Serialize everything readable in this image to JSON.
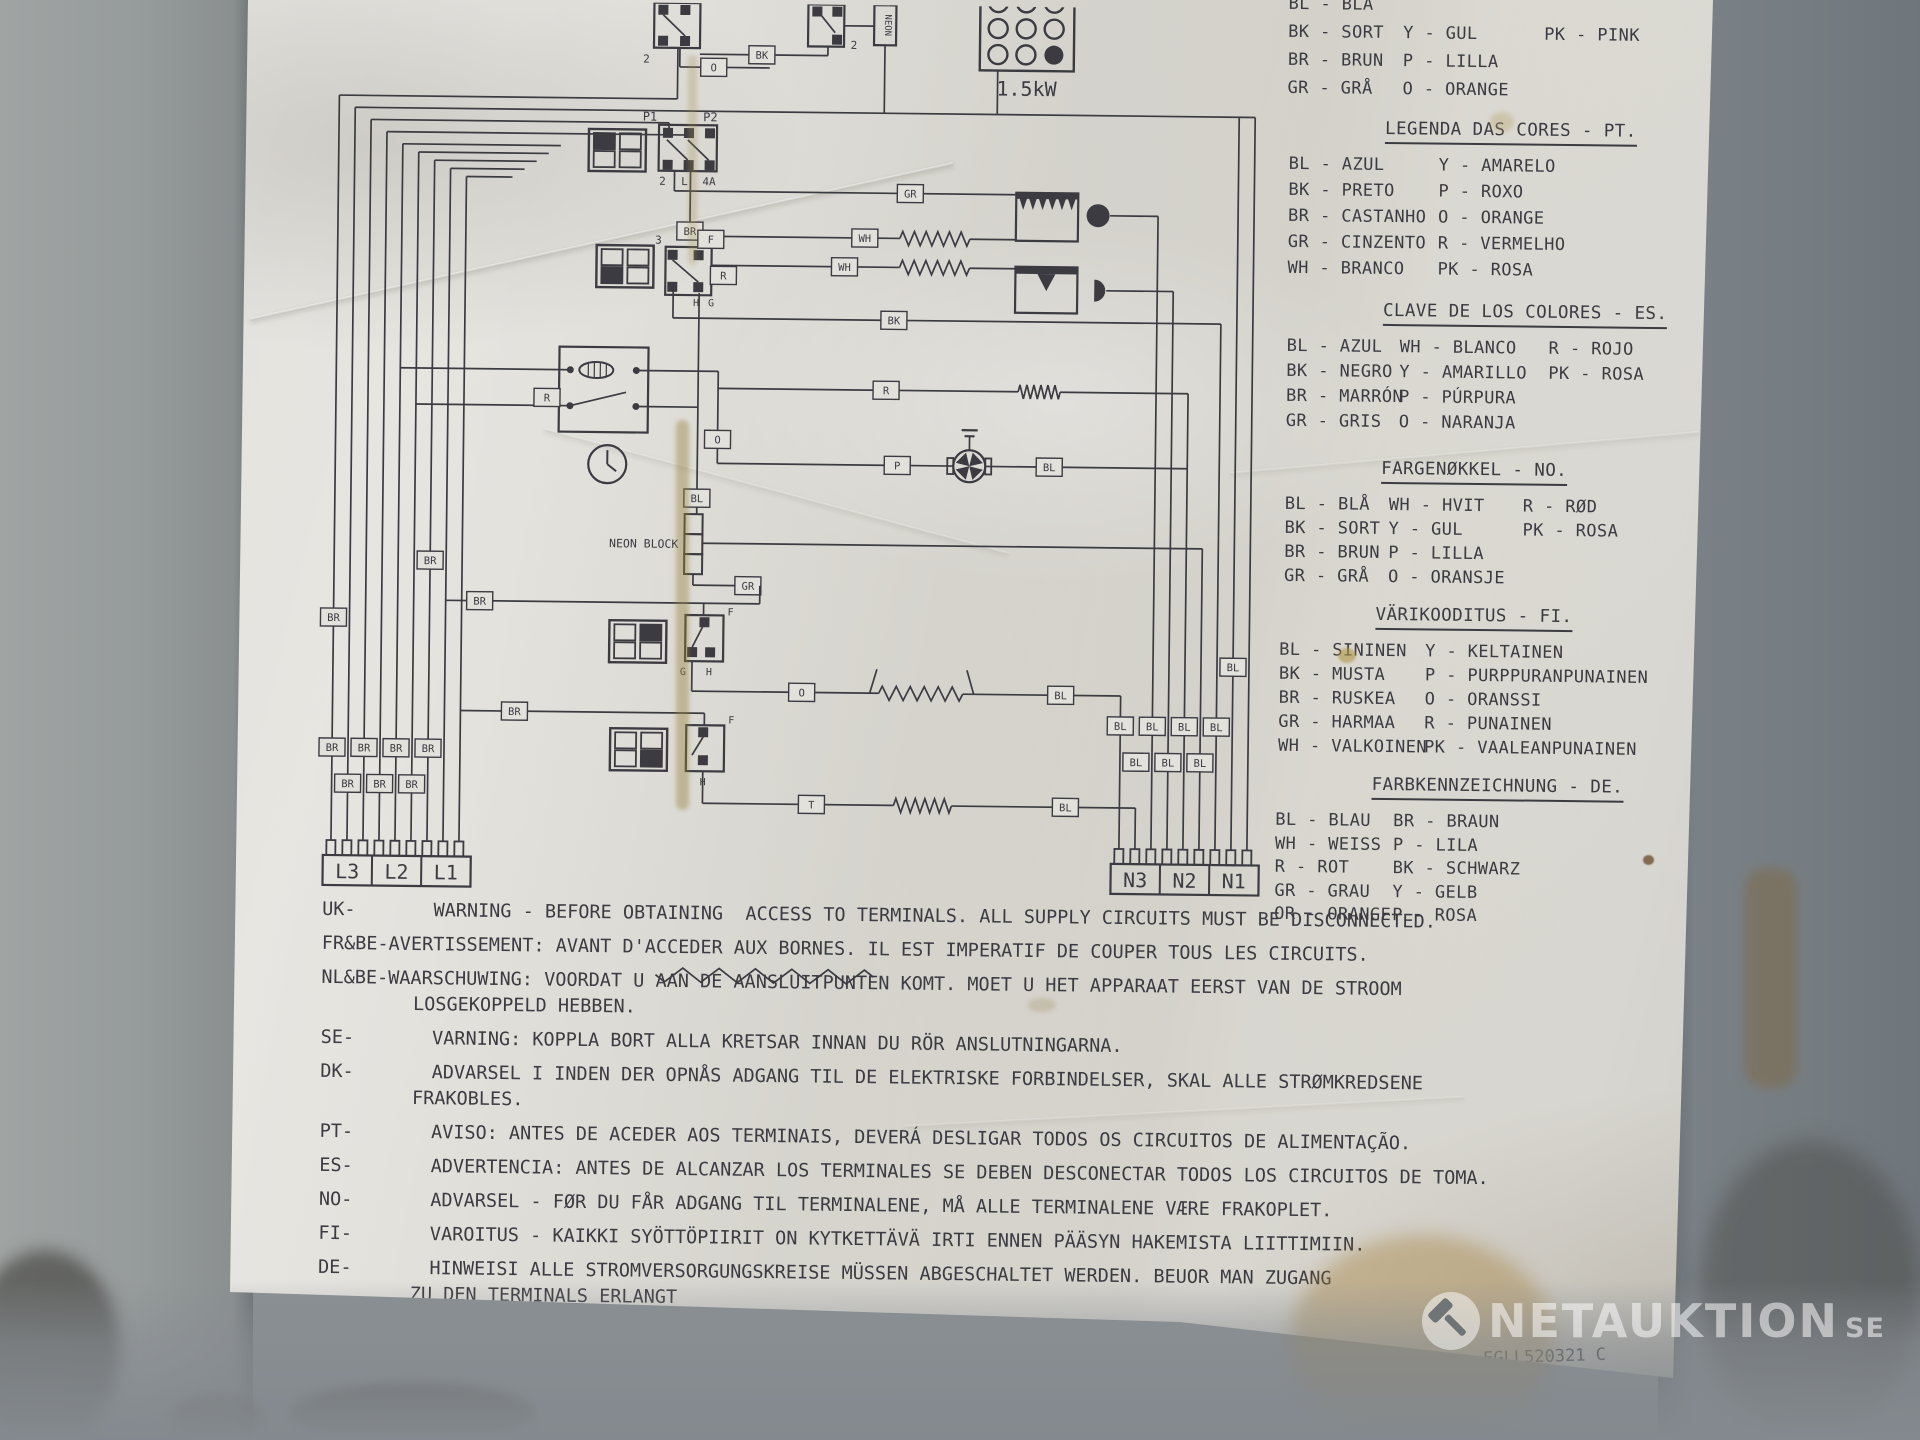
{
  "paper": {
    "legends": [
      {
        "id": "dk-partial",
        "title": "",
        "rows": [
          [
            "BL - BLÅ",
            "",
            ""
          ],
          [
            "BK - SORT",
            "Y - GUL",
            "PK - PINK"
          ],
          [
            "BR - BRUN",
            "P - LILLA",
            ""
          ],
          [
            "GR - GRÅ",
            "O - ORANGE",
            ""
          ]
        ]
      },
      {
        "id": "pt",
        "title": "LEGENDA DAS CORES - PT.",
        "rows": [
          [
            "BL - AZUL",
            "Y - AMARELO"
          ],
          [
            "BK - PRETO",
            "P - ROXO"
          ],
          [
            "BR - CASTANHO",
            "O - ORANGE"
          ],
          [
            "GR - CINZENTO",
            "R - VERMELHO"
          ],
          [
            "WH - BRANCO",
            "PK - ROSA"
          ]
        ]
      },
      {
        "id": "es",
        "title": "CLAVE DE LOS COLORES - ES.",
        "rows": [
          [
            "BL - AZUL",
            "WH - BLANCO",
            "R - ROJO"
          ],
          [
            "BK - NEGRO",
            "Y - AMARILLO",
            "PK - ROSA"
          ],
          [
            "BR - MARRÓN",
            "P - PÚRPURA",
            ""
          ],
          [
            "GR - GRIS",
            "O - NARANJA",
            ""
          ]
        ]
      },
      {
        "id": "no",
        "title": "FARGENØKKEL - NO.",
        "rows": [
          [
            "BL - BLÅ",
            "WH - HVIT",
            "R - RØD"
          ],
          [
            "BK - SORT",
            "Y - GUL",
            "PK - ROSA"
          ],
          [
            "BR - BRUN",
            "P - LILLA",
            ""
          ],
          [
            "GR - GRÅ",
            "O - ORANSJE",
            ""
          ]
        ]
      },
      {
        "id": "fi",
        "title": "VÄRIKOODITUS - FI.",
        "rows": [
          [
            "BL - SININEN",
            "Y - KELTAINEN"
          ],
          [
            "BK - MUSTA",
            "P - PURPPURANPUNAINEN"
          ],
          [
            "BR - RUSKEA",
            "O - ORANSSI"
          ],
          [
            "GR - HARMAA",
            "R - PUNAINEN"
          ],
          [
            "WH - VALKOINEN",
            "PK - VAALEANPUNAINEN"
          ]
        ]
      },
      {
        "id": "de",
        "title": "FARBKENNZEICHNUNG - DE.",
        "rows": [
          [
            "BL - BLAU",
            "BR - BRAUN"
          ],
          [
            "WH - WEISS",
            "P - LILA"
          ],
          [
            "R - ROT",
            "BK - SCHWARZ"
          ],
          [
            "GR - GRAU",
            "Y - GELB"
          ],
          [
            "OR - ORANGE",
            "P - ROSA"
          ]
        ]
      }
    ],
    "warnings": [
      {
        "code": "UK-",
        "text": "WARNING - BEFORE OBTAINING  ACCESS TO TERMINALS. ALL SUPPLY CIRCUITS MUST BE DISCONNECTED."
      },
      {
        "code": "FR&BE-",
        "text": "AVERTISSEMENT: AVANT D'ACCEDER AUX BORNES. IL EST IMPERATIF DE COUPER TOUS LES CIRCUITS."
      },
      {
        "code": "NL&BE-",
        "text": "WAARSCHUWING: VOORDAT U AAN DE AANSLUITPUNTEN KOMT. MOET U HET APPARAAT EERST VAN DE STROOM\nLOSGEKOPPELD HEBBEN."
      },
      {
        "code": "SE-",
        "text": "VARNING: KOPPLA BORT ALLA KRETSAR INNAN DU RÖR ANSLUTNINGARNA."
      },
      {
        "code": "DK-",
        "text": "ADVARSEL I INDEN DER OPNÅS ADGANG TIL DE ELEKTRISKE FORBINDELSER, SKAL ALLE STRØMKREDSENE\nFRAKOBLES."
      },
      {
        "code": "PT-",
        "text": "AVISO: ANTES DE ACEDER AOS TERMINAIS, DEVERÁ DESLIGAR TODOS OS CIRCUITOS DE ALIMENTAÇÃO."
      },
      {
        "code": "ES-",
        "text": "ADVERTENCIA: ANTES DE ALCANZAR LOS TERMINALES SE DEBEN DESCONECTAR TODOS LOS CIRCUITOS DE TOMA."
      },
      {
        "code": "NO-",
        "text": "ADVARSEL - FØR DU FÅR ADGANG TIL TERMINALENE, MÅ ALLE TERMINALENE VÆRE FRAKOPLET."
      },
      {
        "code": "FI-",
        "text": "VAROITUS - KAIKKI SYÖTTÖPIIRIT ON KYTKETTÄVÄ IRTI ENNEN PÄÄSYN HAKEMISTA LIITTIMIIN."
      },
      {
        "code": "DE-",
        "text": "HINWEISI ALLE STROMVERSORGUNGSKREISE MÜSSEN ABGESCHALTET WERDEN. BEUOR MAN ZUGANG\nZU DEN TERMINALS ERLANGT"
      }
    ],
    "doc_number": "EGLL520321 C"
  },
  "schematic": {
    "wire_colors": {
      "BK": "BK",
      "BL": "BL",
      "BR": "BR",
      "GR": "GR",
      "WH": "WH",
      "O": "O",
      "R": "R",
      "P": "P",
      "T": "T",
      "F": "F"
    },
    "pin_labels": {
      "p1": "P1",
      "p2": "P2",
      "two": "2",
      "l": "L",
      "a4": "4A",
      "three": "3",
      "f": "F",
      "g": "G",
      "h": "H"
    },
    "neon": "NEON",
    "neon_block": "NEON BLOCK",
    "power": "1.5kW",
    "l_terminals": [
      "L3",
      "L2",
      "L1"
    ],
    "n_terminals": [
      "N3",
      "N2",
      "N1"
    ]
  },
  "watermark": {
    "brand": "NETAUKTION",
    "tld": "SE"
  },
  "colors": {
    "ink": "#3b3b41",
    "paper": "#e3e1db"
  }
}
